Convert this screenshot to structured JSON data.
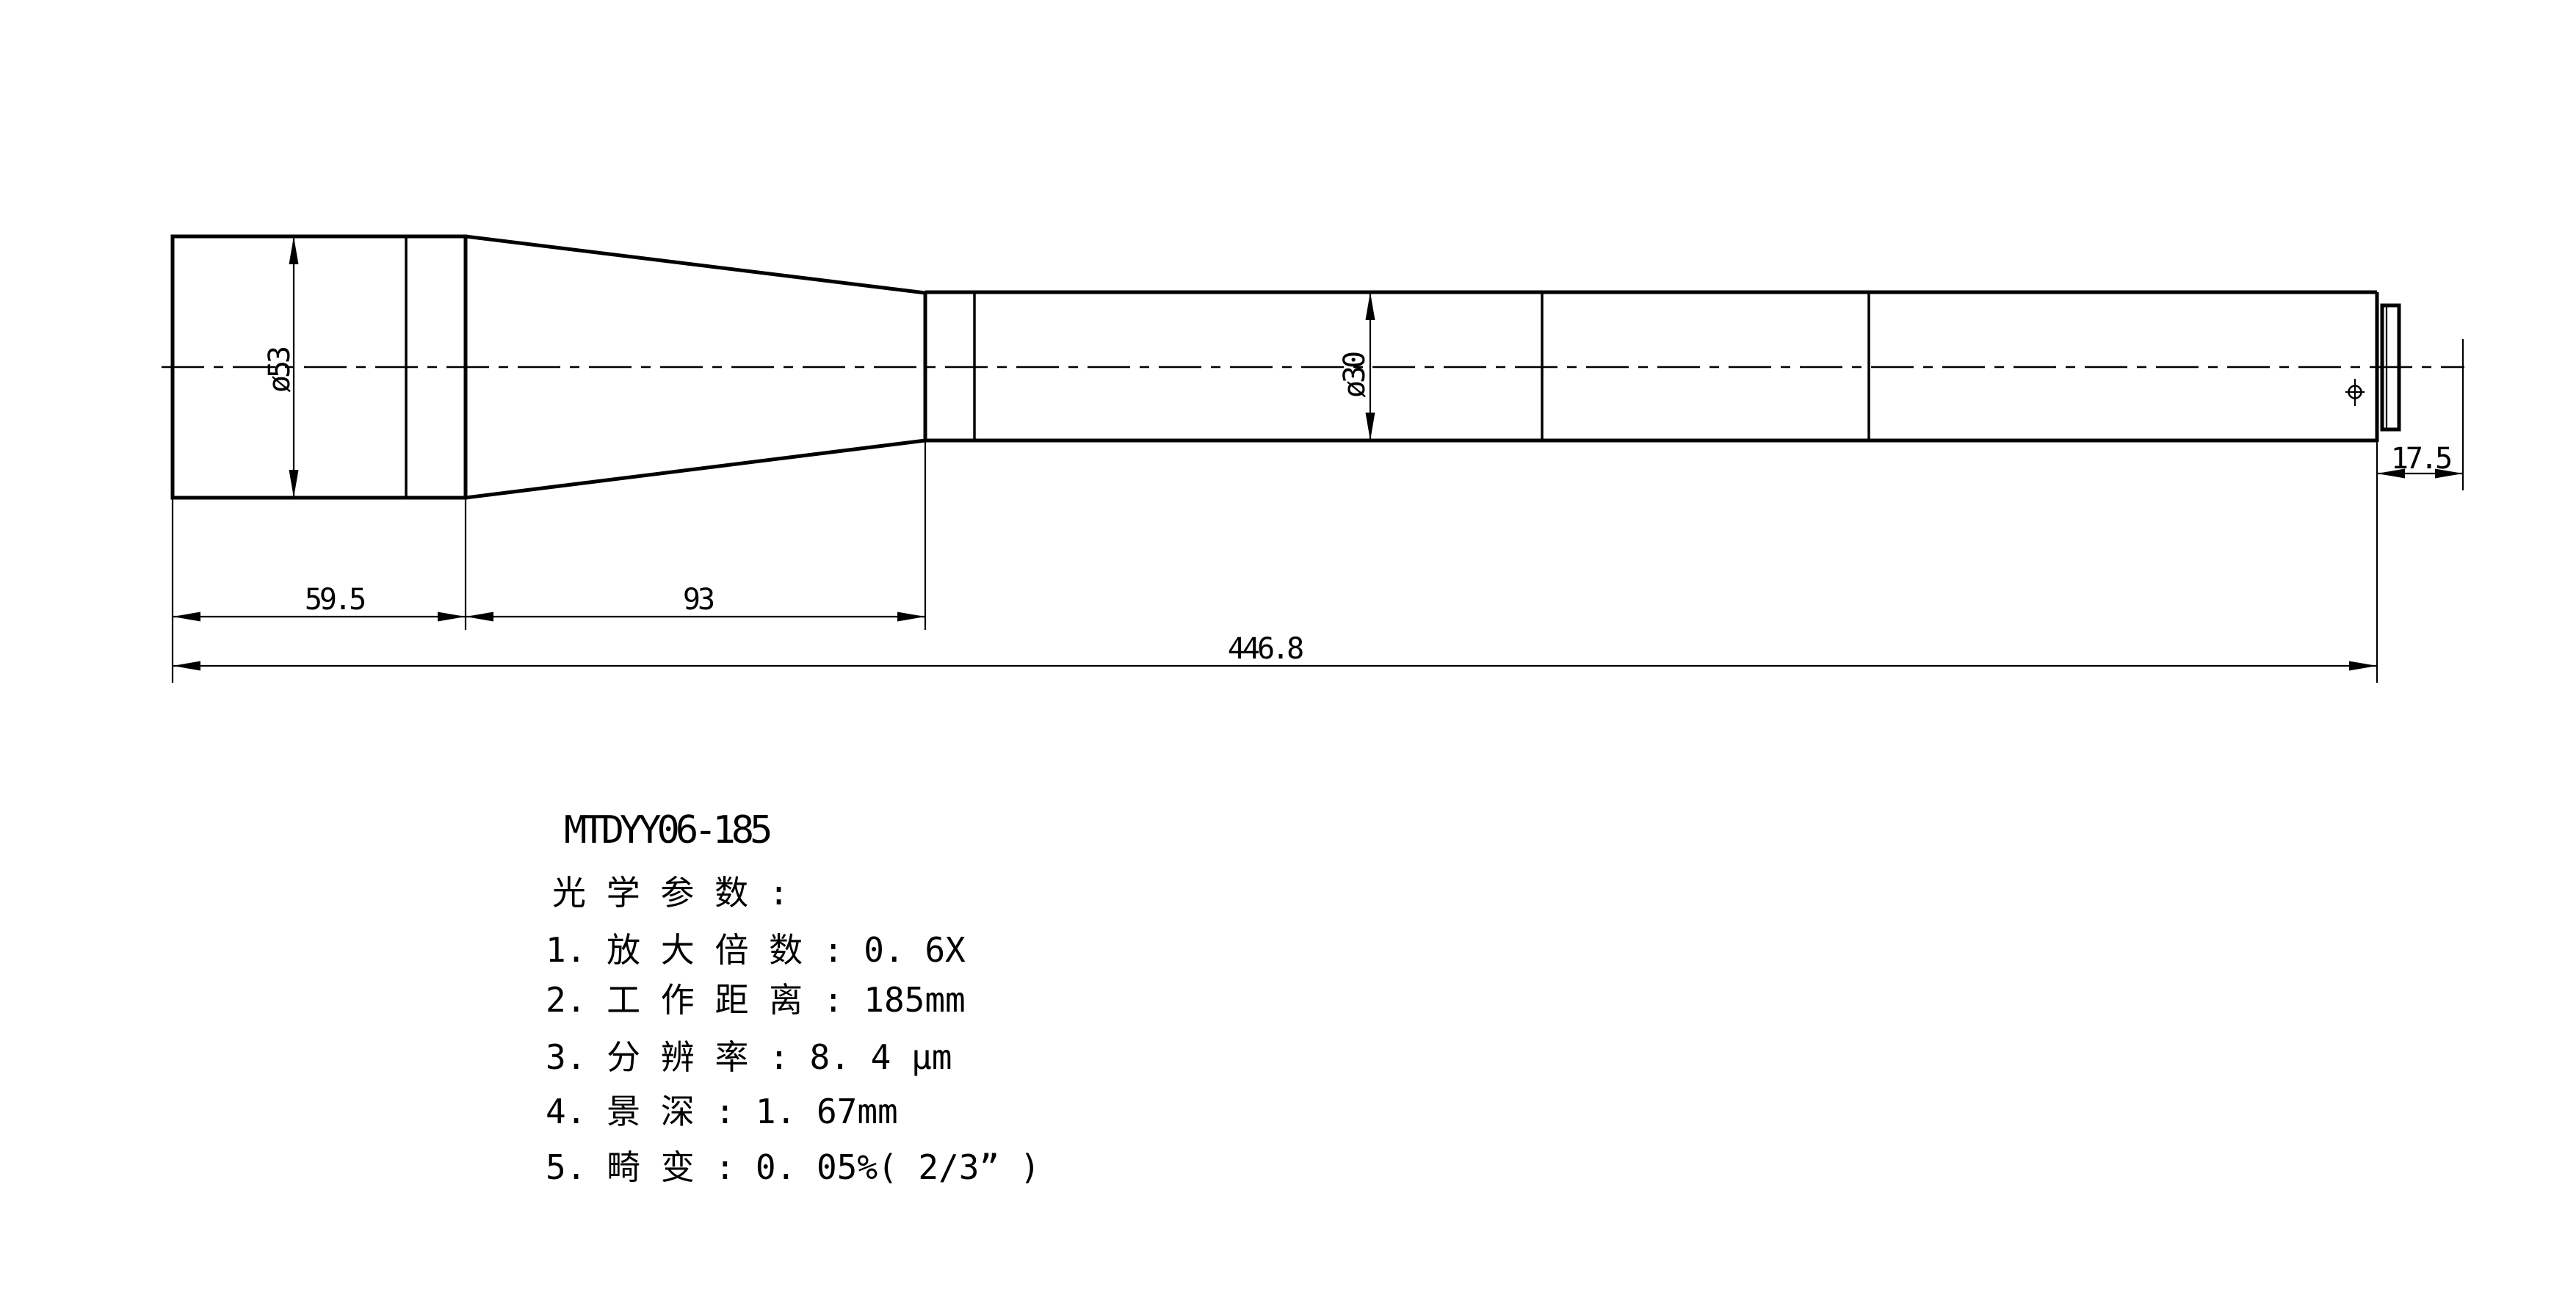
{
  "page": {
    "background": "#ffffff",
    "line_color": "#000000"
  },
  "model": "MTDYY06-185",
  "dimensions": {
    "front_diameter": "ø53",
    "tube_diameter": "ø30",
    "front_length": "59.5",
    "taper_length": "93",
    "total_length": "446.8",
    "flange_distance": "17.5"
  },
  "specs": {
    "header": "光 学 参 数 :",
    "items": [
      "1. 放 大 倍 数 : 0. 6X",
      "2. 工 作 距 离 : 185mm",
      "3. 分 辨 率 : 8. 4 μm",
      "4. 景 深 : 1. 67mm",
      "5. 畸 变 : 0. 05%( 2/3” )"
    ]
  }
}
